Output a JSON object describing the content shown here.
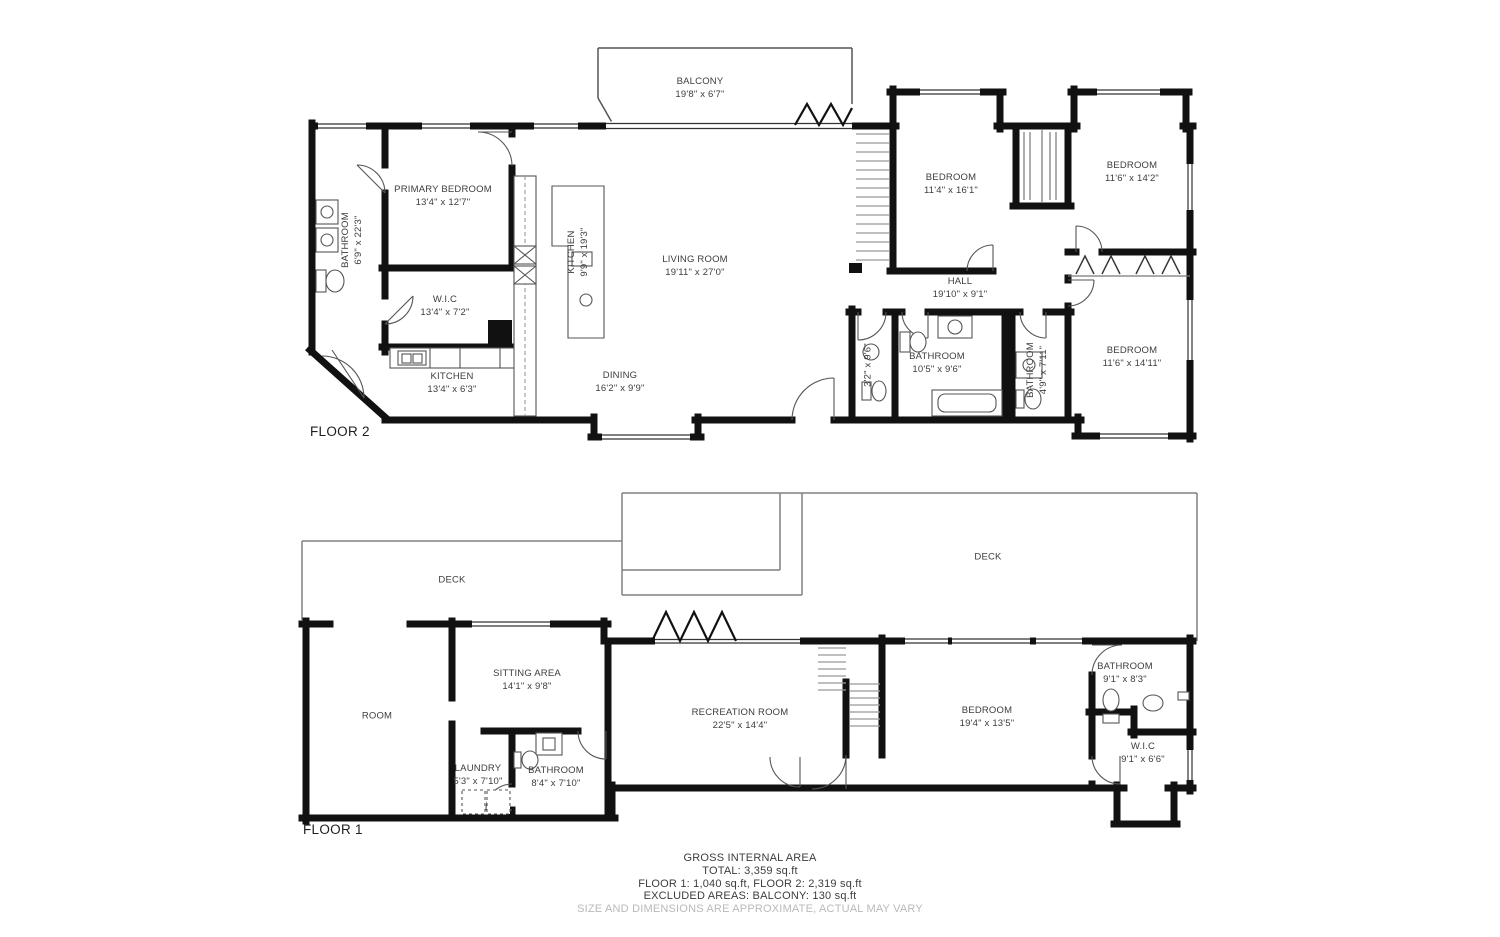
{
  "colors": {
    "wall": "#111111",
    "thin_line": "#555555",
    "deck_line": "#808080",
    "label_text": "#3d3d3d",
    "muted_text": "#b9b9b9"
  },
  "floor2": {
    "label": "FLOOR 2",
    "rooms": [
      {
        "name": "BALCONY",
        "dims": "19'8\" x 6'7\""
      },
      {
        "name": "PRIMARY BEDROOM",
        "dims": "13'4\" x 12'7\""
      },
      {
        "name": "BATHROOM",
        "dims": "6'9\" x 22'3\""
      },
      {
        "name": "W.I.C",
        "dims": "13'4\" x 7'2\""
      },
      {
        "name": "KITCHEN",
        "dims": "13'4\" x 6'3\""
      },
      {
        "name": "KITCHEN",
        "dims": "9'9\" x 19'3\""
      },
      {
        "name": "LIVING ROOM",
        "dims": "19'11\" x 27'0\""
      },
      {
        "name": "DINING",
        "dims": "16'2\" x 9'9\""
      },
      {
        "name": "HALL",
        "dims": "19'10\" x 9'1\""
      },
      {
        "name": "BEDROOM",
        "dims": "11'4\" x 16'1\""
      },
      {
        "name": "BEDROOM",
        "dims": "11'6\" x 14'2\""
      },
      {
        "name": "BEDROOM",
        "dims": "11'6\" x 14'11\""
      },
      {
        "name": "BATHROOM",
        "dims": "10'5\" x 9'6\""
      },
      {
        "name": "BATHROOM",
        "dims": "4'9\" x 7'11\""
      },
      {
        "name": "W.C",
        "dims": "3'2\" x 9'6\""
      }
    ]
  },
  "floor1": {
    "label": "FLOOR 1",
    "rooms": [
      {
        "name": "DECK"
      },
      {
        "name": "DECK"
      },
      {
        "name": "ROOM"
      },
      {
        "name": "SITTING AREA",
        "dims": "14'1\" x 9'8\""
      },
      {
        "name": "RECREATION ROOM",
        "dims": "22'5\" x 14'4\""
      },
      {
        "name": "BEDROOM",
        "dims": "19'4\" x 13'5\""
      },
      {
        "name": "LAUNDRY",
        "dims": "5'3\" x 7'10\""
      },
      {
        "name": "BATHROOM",
        "dims": "8'4\" x 7'10\""
      },
      {
        "name": "BATHROOM",
        "dims": "9'1\" x 8'3\""
      },
      {
        "name": "W.I.C",
        "dims": "9'1\" x 6'6\""
      }
    ]
  },
  "footer": {
    "title": "GROSS INTERNAL AREA",
    "total": "TOTAL: 3,359 sq.ft",
    "floors": "FLOOR 1: 1,040 sq.ft, FLOOR 2: 2,319 sq.ft",
    "excluded": "EXCLUDED AREAS: BALCONY: 130 sq.ft",
    "disclaimer": "SIZE AND DIMENSIONS ARE APPROXIMATE, ACTUAL MAY VARY"
  }
}
